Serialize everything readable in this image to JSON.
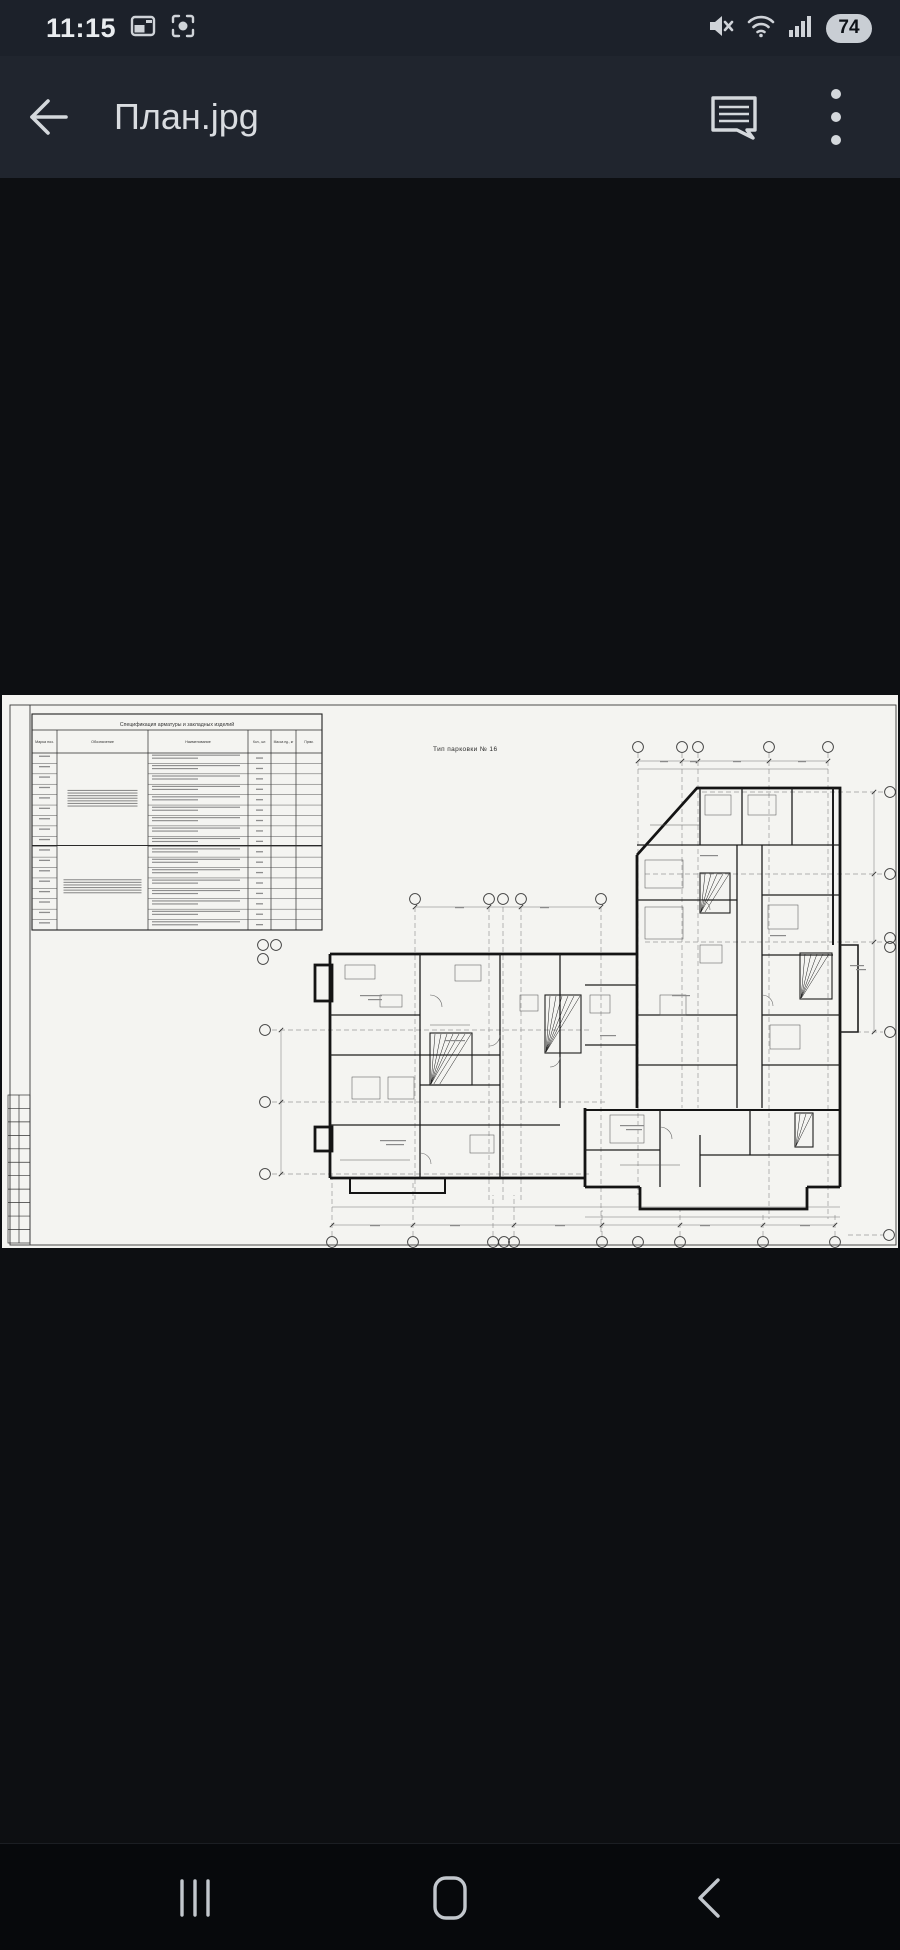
{
  "status_bar": {
    "time": "11:15",
    "battery_percent": "74",
    "left_icons": [
      "gallery-notification-icon",
      "screen-capture-icon"
    ],
    "right_icons": [
      "mute-icon",
      "wifi-icon",
      "signal-icon",
      "battery-pill"
    ]
  },
  "app_bar": {
    "title": "План.jpg",
    "actions": [
      "back-button",
      "comment-button",
      "overflow-menu-button"
    ]
  },
  "viewer": {
    "file_name": "План.jpg",
    "document_type": "architectural floor plan scan"
  },
  "drawing": {
    "title": "Тип парковки № 16",
    "spec_table": {
      "title": "Спецификация арматуры и закладных изделий",
      "columns": [
        "Марка поз.",
        "Обозначение",
        "Наименование",
        "Кол., шт.",
        "Масса ед., кг",
        "Прим."
      ]
    }
  },
  "nav_bar": {
    "buttons": [
      "recents-button",
      "home-button",
      "back-button"
    ]
  },
  "colors": {
    "bar_bg": "#20252e",
    "status_bg": "#1c212a",
    "content_bg": "#0d0f12",
    "nav_bg": "#07090c",
    "paper": "#f4f4f1",
    "ink": "#151515",
    "icon_fg": "#d4d8dc"
  }
}
